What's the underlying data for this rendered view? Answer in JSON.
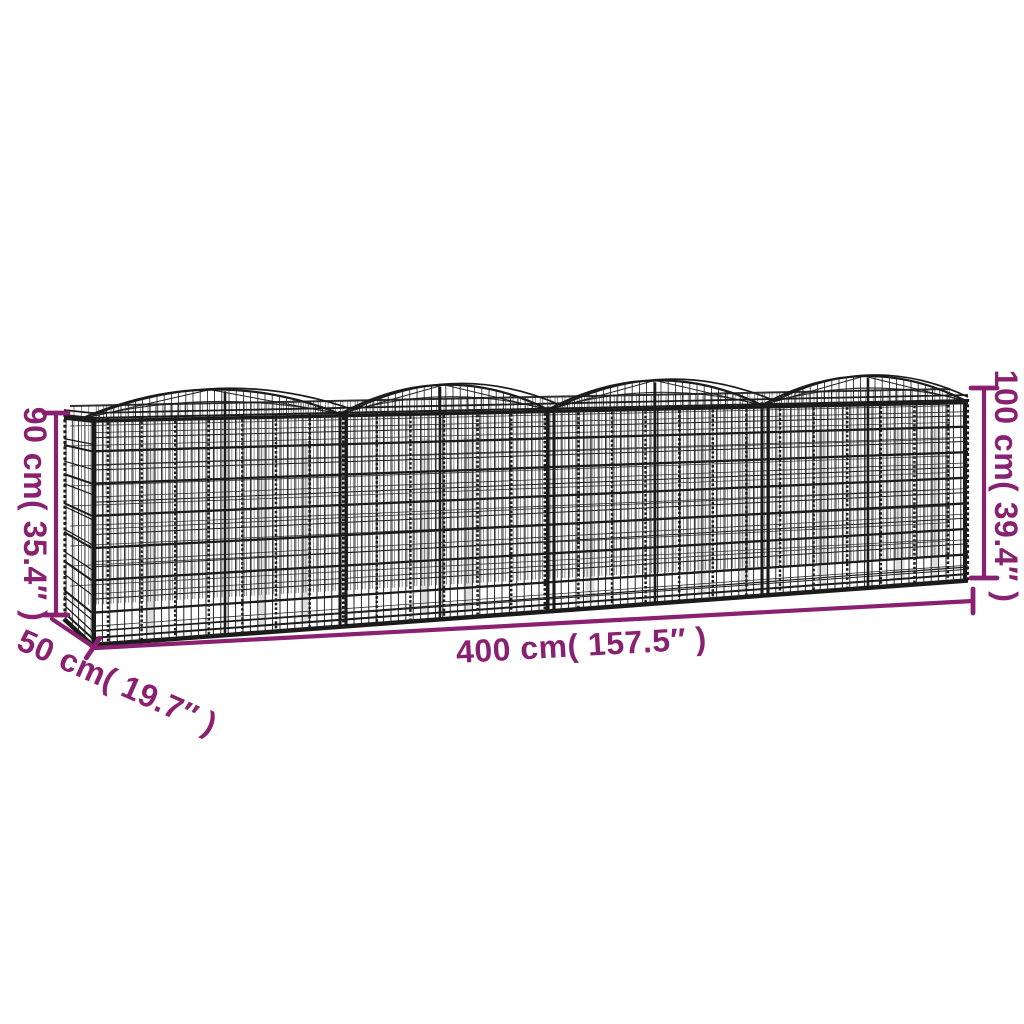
{
  "diagram_type": "product dimension diagram",
  "subject": "wire gabion raised bed basket with four arched tops",
  "dimensions": {
    "width": "400 cm( 157.5″ )",
    "depth": "50 cm( 19.7″ )",
    "height_left": "90 cm( 35.4″ )",
    "height_right": "100 cm( 39.4″ )"
  },
  "colors": {
    "dimension_accent": "#8A2170",
    "wire": "#1B1B1B",
    "background": "#FFFFFF"
  }
}
